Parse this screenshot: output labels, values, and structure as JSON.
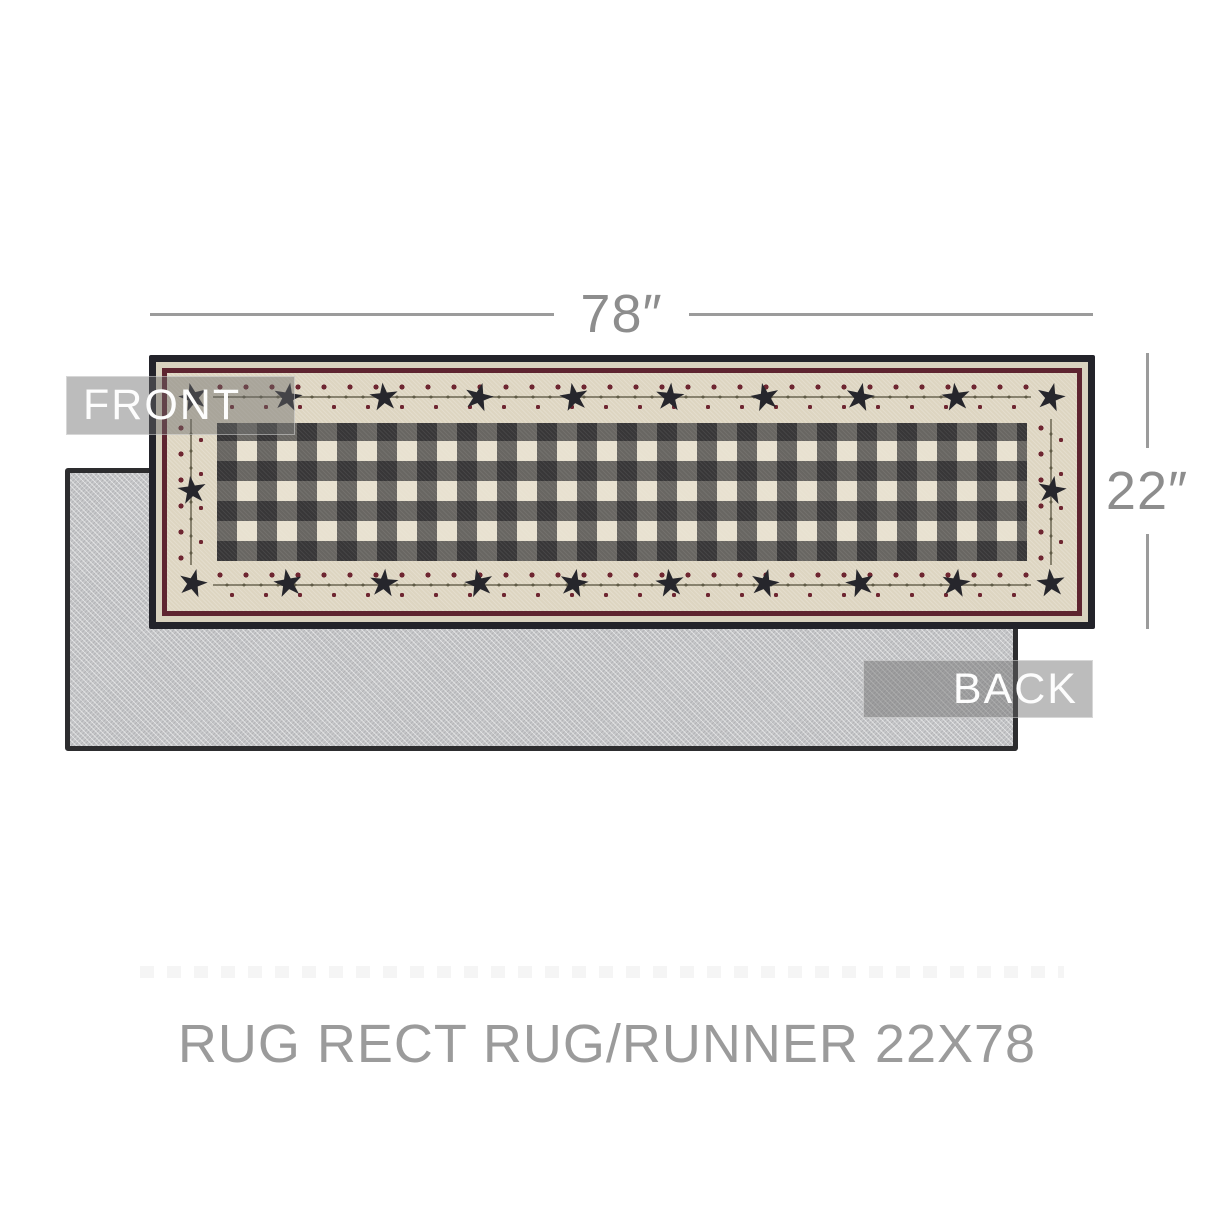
{
  "product_view": {
    "front_tag": "FRONT",
    "back_tag": "BACK",
    "caption": "RUG RECT RUG/RUNNER 22X78"
  },
  "dimensions": {
    "width_label": "78″",
    "height_label": "22″"
  },
  "icons": {
    "star": "★"
  },
  "colors": {
    "rug_border_black": "#23232a",
    "rug_cream_band": "#d9d2bf",
    "rug_maroon_stripe": "#5e2430",
    "star_band_cream": "#ddd5c1",
    "star_black": "#26262c",
    "berry_maroon": "#6e2631",
    "check_dark": "#353538",
    "check_mid": "#6e6d6c",
    "check_light": "#e8e1d0",
    "back_rug_gray": "#c6c7c9",
    "back_rug_border": "#2d2d2f",
    "label_overlay": "rgba(106,106,106,0.45)",
    "label_text": "#fdfdfd",
    "dimension_line": "#9b9b9b",
    "dimension_text": "#8d8d8d",
    "caption_text": "#9b9b9b",
    "background": "#ffffff"
  }
}
